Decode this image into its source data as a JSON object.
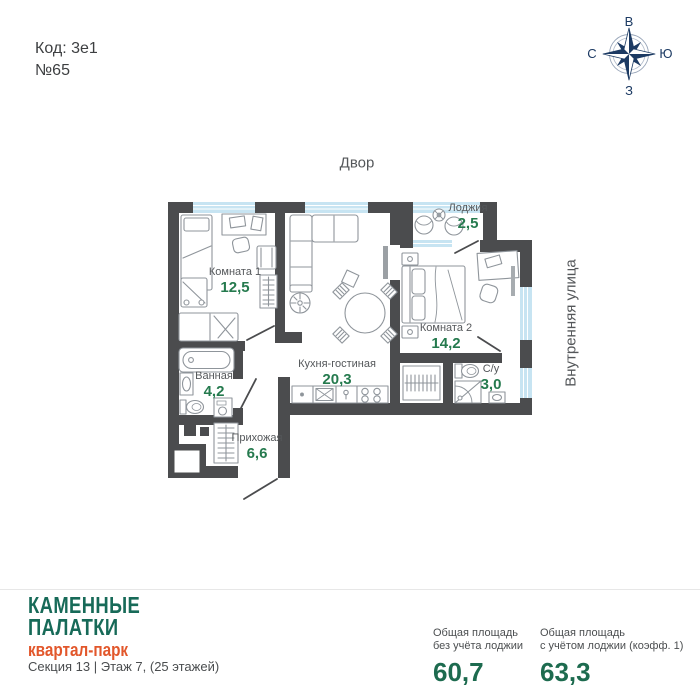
{
  "header": {
    "code_label": "Код: 3е1",
    "unit_number": "№65"
  },
  "compass": {
    "top": "В",
    "right": "Ю",
    "bottom": "З",
    "left": "С"
  },
  "plan": {
    "outside": {
      "top": "Двор",
      "right": "Внутренняя улица"
    },
    "rooms": [
      {
        "name": "Комната 1",
        "area": "12,5"
      },
      {
        "name": "Лоджия",
        "area": "2,5"
      },
      {
        "name": "Комната 2",
        "area": "14,2"
      },
      {
        "name": "Кухня-гостиная",
        "area": "20,3"
      },
      {
        "name": "Ванная",
        "area": "4,2"
      },
      {
        "name": "С/у",
        "area": "3,0"
      },
      {
        "name": "Прихожая",
        "area": "6,6"
      }
    ]
  },
  "footer": {
    "brand_line1": "КАМЕННЫЕ",
    "brand_line2": "ПАЛАТКИ",
    "brand_sub": "квартал-парк",
    "section_info": "Секция 13 | Этаж 7, (25 этажей)",
    "stats": [
      {
        "label_line1": "Общая площадь",
        "label_line2": "без учёта лоджии",
        "value": "60,7"
      },
      {
        "label_line1": "Общая площадь",
        "label_line2": "с учётом лоджии (коэфф. 1)",
        "value": "63,3"
      }
    ]
  },
  "colors": {
    "wall": "#4b4c4e",
    "window": "#c7e4f2",
    "area_green": "#257a4e",
    "brand_teal": "#176a58",
    "brand_orange": "#e2572b",
    "stat_green": "#1d6b4f",
    "compass_navy": "#1c3a63"
  }
}
